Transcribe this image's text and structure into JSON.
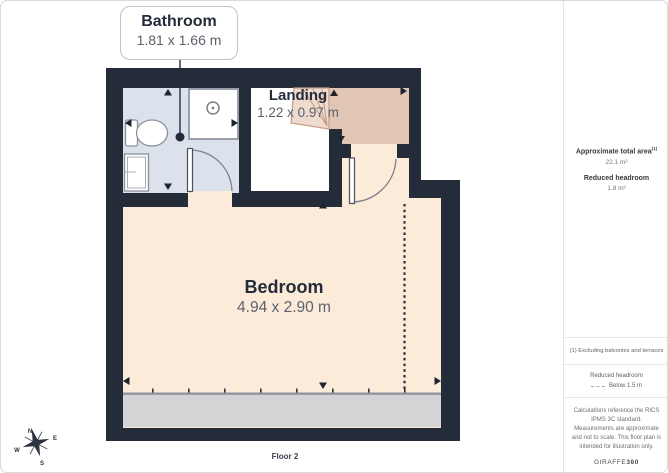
{
  "page": {
    "floor_label": "Floor 2"
  },
  "rooms": {
    "bathroom": {
      "name": "Bathroom",
      "dims": "1.81 x 1.66 m"
    },
    "landing": {
      "name": "Landing",
      "dims": "1.22 x 0.97 m"
    },
    "bedroom": {
      "name": "Bedroom",
      "dims": "4.94 x 2.90 m"
    }
  },
  "sidebar": {
    "total_area_label": "Approximate total area",
    "total_area_sup": "(1)",
    "total_area_value": "22.1 m²",
    "reduced_headroom_label": "Reduced headroom",
    "reduced_headroom_value": "1.8 m²",
    "footnote": "(1) Excluding balconies and terraces",
    "legend_title": "Reduced headroom",
    "legend_item": "Below 1.5 m",
    "disclaimer": "Calculations reference the RICS IPMS 3C standard. Measurements are approximate and not to scale. This floor plan is intended for illustration only.",
    "brand_name": "GIRAFFE",
    "brand_suffix": "360"
  },
  "compass": {
    "n": "N",
    "e": "E",
    "s": "S",
    "w": "W"
  },
  "colors": {
    "wall": "#242c3a",
    "bathroom_floor": "#dce2ec",
    "bedroom_floor": "#fcebd9",
    "stairs_area": "#e2c6b5",
    "stairs_steps": "#eedbd0",
    "reduced_headroom_fill": "#d3d4d6",
    "dashed_boundary": "#242c3a",
    "page_border": "#d8dadd"
  }
}
